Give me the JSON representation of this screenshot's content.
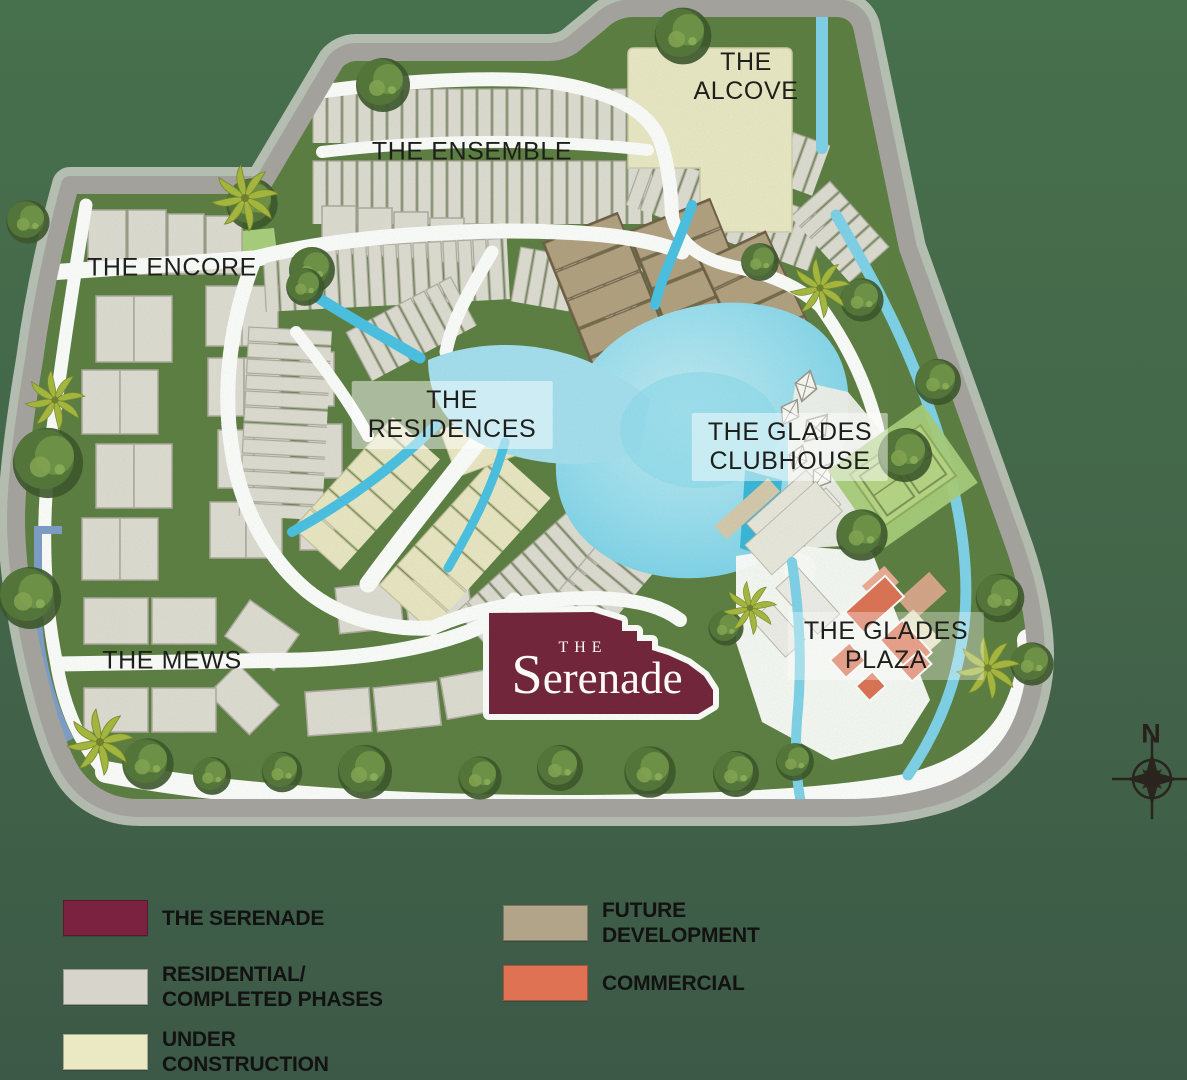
{
  "map": {
    "areas": {
      "alcove": {
        "label": "THE\nALCOVE"
      },
      "ensemble": {
        "label": "THE ENSEMBLE"
      },
      "encore": {
        "label": "THE ENCORE"
      },
      "residences": {
        "label": "THE\nRESIDENCES"
      },
      "glades_clubhouse": {
        "label": "THE GLADES\nCLUBHOUSE"
      },
      "glades_plaza": {
        "label": "THE GLADES\nPLAZA"
      },
      "mews": {
        "label": "THE MEWS"
      }
    },
    "serenade_logo": {
      "prefix": "THE",
      "name": "Serenade"
    },
    "compass": {
      "north_label": "N"
    }
  },
  "legend": {
    "items": [
      {
        "id": "serenade",
        "label": "THE SERENADE",
        "color": "#7b2240"
      },
      {
        "id": "residential",
        "label": "RESIDENTIAL/\nCOMPLETED PHASES",
        "color": "#d7d4cc"
      },
      {
        "id": "under-construction",
        "label": "UNDER\nCONSTRUCTION",
        "color": "#ebe8c4"
      },
      {
        "id": "future-development",
        "label": "FUTURE\nDEVELOPMENT",
        "color": "#b2a489"
      },
      {
        "id": "commercial",
        "label": "COMMERCIAL",
        "color": "#e07254"
      }
    ]
  },
  "colors": {
    "background": "#436549",
    "grass": "#5b7d41",
    "perimeter_road": "#a3a19b",
    "internal_road": "#ffffff",
    "stream": "#49c1e6",
    "lake": "#a5e0f2",
    "serenade": "#72203a",
    "residential": "#e0ddd5",
    "under_construction": "#ece8c5",
    "future_development": "#b2a081",
    "commercial": "#de7154"
  }
}
